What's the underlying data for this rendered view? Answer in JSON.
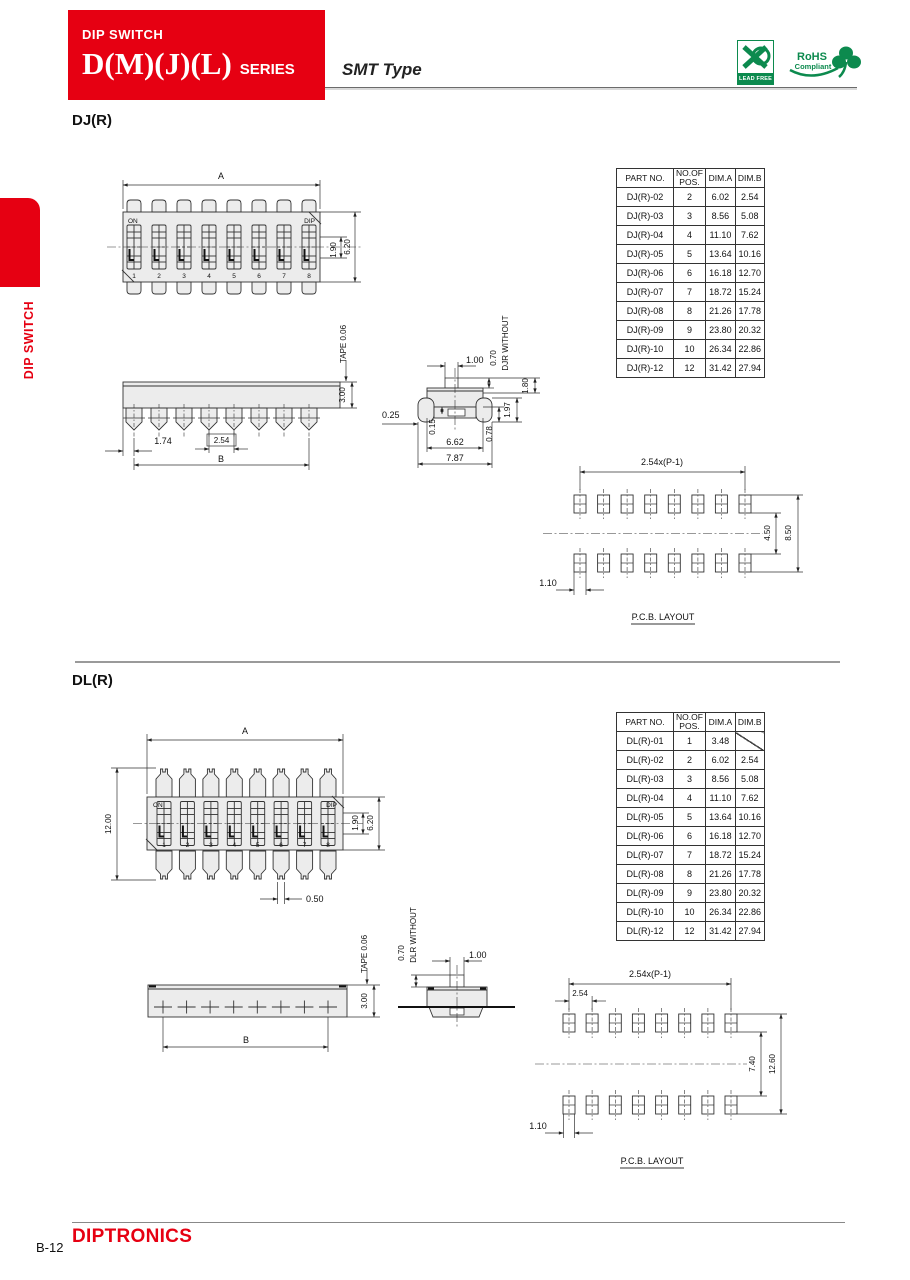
{
  "header": {
    "category": "DIP SWITCH",
    "series": "D(M)(J)(L)",
    "series_suffix": "SERIES",
    "type_label": "SMT Type",
    "lead_free_label": "LEAD FREE",
    "rohs_line1": "RoHS",
    "rohs_line2": "Compliant"
  },
  "sidebar": {
    "tab_label": "DIP SWITCH"
  },
  "footer": {
    "brand": "DIPTRONICS",
    "page_code": "B-12"
  },
  "table_headers": {
    "part_no": "PART NO.",
    "pos_line1": "NO.OF",
    "pos_line2": "POS.",
    "dim_a": "DIM.A",
    "dim_b": "DIM.B"
  },
  "dj": {
    "heading": "DJ(R)",
    "table_rows": [
      [
        "DJ(R)-02",
        "2",
        "6.02",
        "2.54"
      ],
      [
        "DJ(R)-03",
        "3",
        "8.56",
        "5.08"
      ],
      [
        "DJ(R)-04",
        "4",
        "11.10",
        "7.62"
      ],
      [
        "DJ(R)-05",
        "5",
        "13.64",
        "10.16"
      ],
      [
        "DJ(R)-06",
        "6",
        "16.18",
        "12.70"
      ],
      [
        "DJ(R)-07",
        "7",
        "18.72",
        "15.24"
      ],
      [
        "DJ(R)-08",
        "8",
        "21.26",
        "17.78"
      ],
      [
        "DJ(R)-09",
        "9",
        "23.80",
        "20.32"
      ],
      [
        "DJ(R)-10",
        "10",
        "26.34",
        "22.86"
      ],
      [
        "DJ(R)-12",
        "12",
        "31.42",
        "27.94"
      ]
    ],
    "top_view": {
      "dim_a": "A",
      "dim_inner": "1.90",
      "dim_outer": "6.20",
      "on": "ON",
      "dip": "DIP",
      "positions": [
        "1",
        "2",
        "3",
        "4",
        "5",
        "6",
        "7",
        "8"
      ]
    },
    "side_view": {
      "tape": "TAPE  0.06",
      "thickness": "3.00",
      "edge_offset": "1.74",
      "pitch": "2.54",
      "dim_b": "B"
    },
    "section_view": {
      "top_width": "1.00",
      "travel": "0.70",
      "note": "DJR  WITHOUT",
      "h_stem": "1.80",
      "h_body": "1.97",
      "h_lead": "0.78",
      "h_seat": "0.15",
      "lead_offset": "0.25",
      "w_body": "6.62",
      "w_total": "7.87"
    },
    "pcb": {
      "pitch_formula": "2.54x(P-1)",
      "row_gap": "4.50",
      "row_span": "8.50",
      "pad_width": "1.10",
      "caption": "P.C.B.  LAYOUT"
    }
  },
  "dl": {
    "heading": "DL(R)",
    "table_rows": [
      [
        "DL(R)-01",
        "1",
        "3.48",
        null
      ],
      [
        "DL(R)-02",
        "2",
        "6.02",
        "2.54"
      ],
      [
        "DL(R)-03",
        "3",
        "8.56",
        "5.08"
      ],
      [
        "DL(R)-04",
        "4",
        "11.10",
        "7.62"
      ],
      [
        "DL(R)-05",
        "5",
        "13.64",
        "10.16"
      ],
      [
        "DL(R)-06",
        "6",
        "16.18",
        "12.70"
      ],
      [
        "DL(R)-07",
        "7",
        "18.72",
        "15.24"
      ],
      [
        "DL(R)-08",
        "8",
        "21.26",
        "17.78"
      ],
      [
        "DL(R)-09",
        "9",
        "23.80",
        "20.32"
      ],
      [
        "DL(R)-10",
        "10",
        "26.34",
        "22.86"
      ],
      [
        "DL(R)-12",
        "12",
        "31.42",
        "27.94"
      ]
    ],
    "top_view": {
      "dim_a": "A",
      "height": "12.00",
      "dim_inner": "1.90",
      "dim_outer": "6.20",
      "pin_tip": "0.50",
      "on": "ON",
      "dip": "DIP",
      "positions": [
        "1",
        "2",
        "3",
        "4",
        "5",
        "6",
        "7",
        "8"
      ]
    },
    "side_view": {
      "tape": "TAPE  0.06",
      "thickness": "3.00",
      "dim_b": "B"
    },
    "section_view": {
      "top_width": "1.00",
      "travel": "0.70",
      "note": "DLR  WITHOUT"
    },
    "pcb": {
      "pitch_formula": "2.54x(P-1)",
      "pitch": "2.54",
      "row_gap": "7.40",
      "row_span": "12.60",
      "pad_width": "1.10",
      "caption": "P.C.B.  LAYOUT"
    }
  }
}
